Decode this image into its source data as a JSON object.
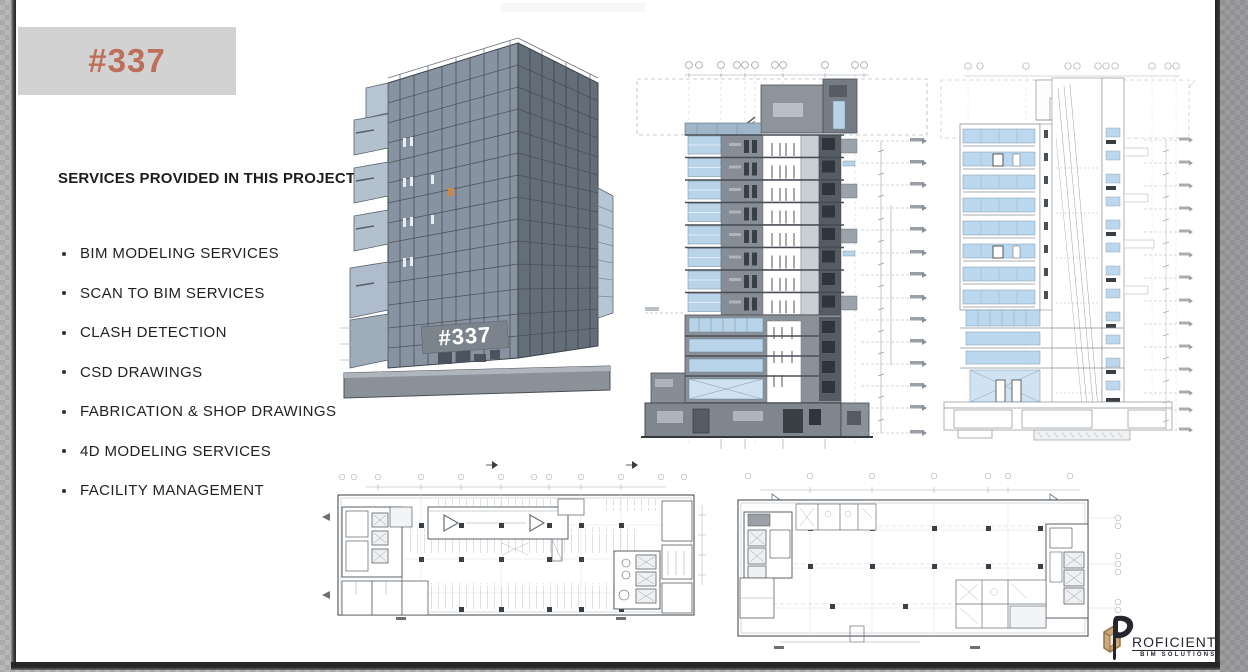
{
  "slide": {
    "header": {
      "project_number": "#337"
    },
    "services": {
      "title": "SERVICES PROVIDED IN THIS PROJECT",
      "items": [
        "BIM MODELING SERVICES",
        "SCAN TO BIM SERVICES",
        "CLASH DETECTION",
        "CSD DRAWINGS",
        "FABRICATION & SHOP DRAWINGS",
        "4D MODELING SERVICES",
        "FACILITY MANAGEMENT"
      ]
    },
    "building_render": {
      "sign_text": "#337"
    },
    "logo": {
      "monogram": "P",
      "name_rest": "ROFICIENT",
      "tagline": "BIM SOLUTIONS"
    }
  },
  "colors": {
    "accent_terracotta": "#BF6F59",
    "header_bg": "#D2D2D2",
    "slide_bg": "#FFFFFF",
    "glazing_blue": "#B9D6EC",
    "steel_gray": "#7E8A96",
    "dark_shaft": "#31373E",
    "logo_navy": "#26262F",
    "logo_gold": "#B3976B"
  }
}
